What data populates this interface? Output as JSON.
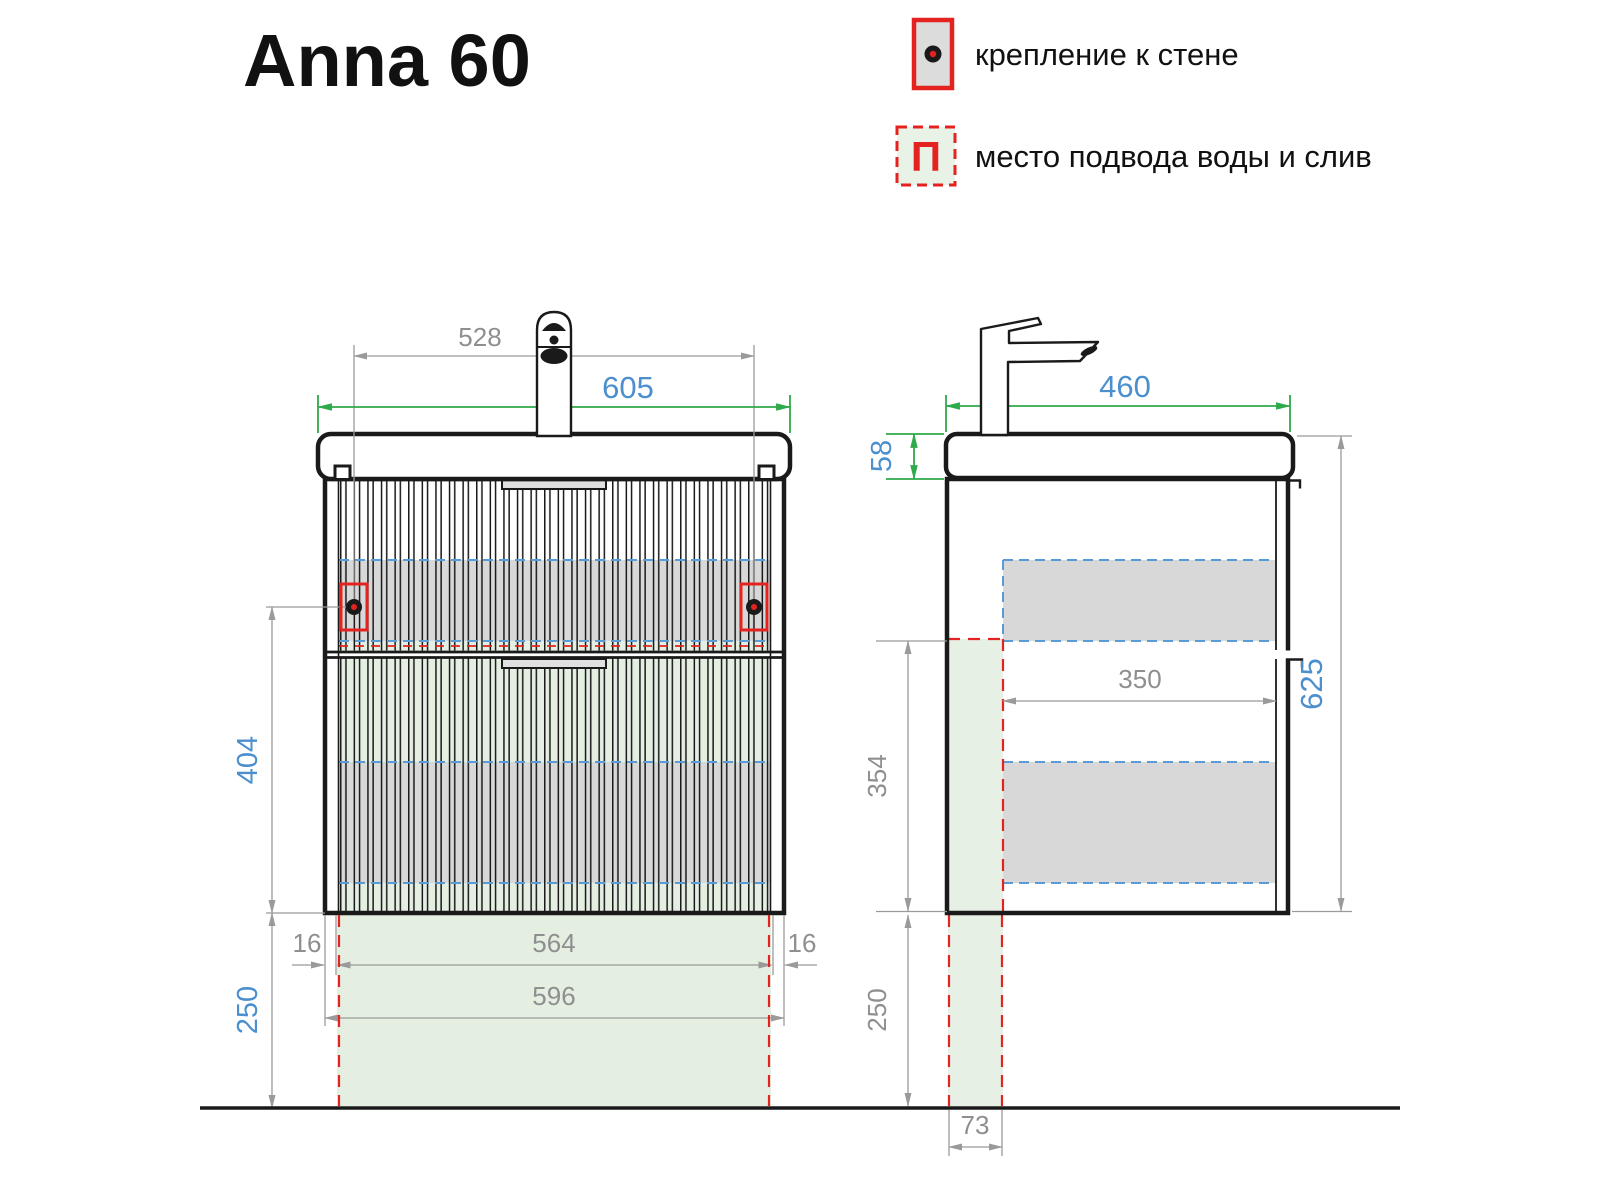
{
  "title": "Anna 60",
  "legend": {
    "wall_mount": {
      "label": "крепление к стене"
    },
    "water": {
      "label": "место подвода воды и слив",
      "symbol": "П"
    }
  },
  "front": {
    "d528": "528",
    "d605": "605",
    "d404": "404",
    "d250": "250",
    "d16l": "16",
    "d564": "564",
    "d16r": "16",
    "d596": "596"
  },
  "side": {
    "d460": "460",
    "d58": "58",
    "d625": "625",
    "d350": "350",
    "d354": "354",
    "d250": "250",
    "d73": "73"
  },
  "colors": {
    "line_black": "#1a1a1a",
    "dim_gray": "#9a9a9a",
    "dim_green": "#2faa4a",
    "text_blue": "#4b8fce",
    "dash_blue": "#5b9bd5",
    "accent_red": "#e42320",
    "band_gray": "#d8d8d8",
    "band_green": "#e4efe2"
  }
}
